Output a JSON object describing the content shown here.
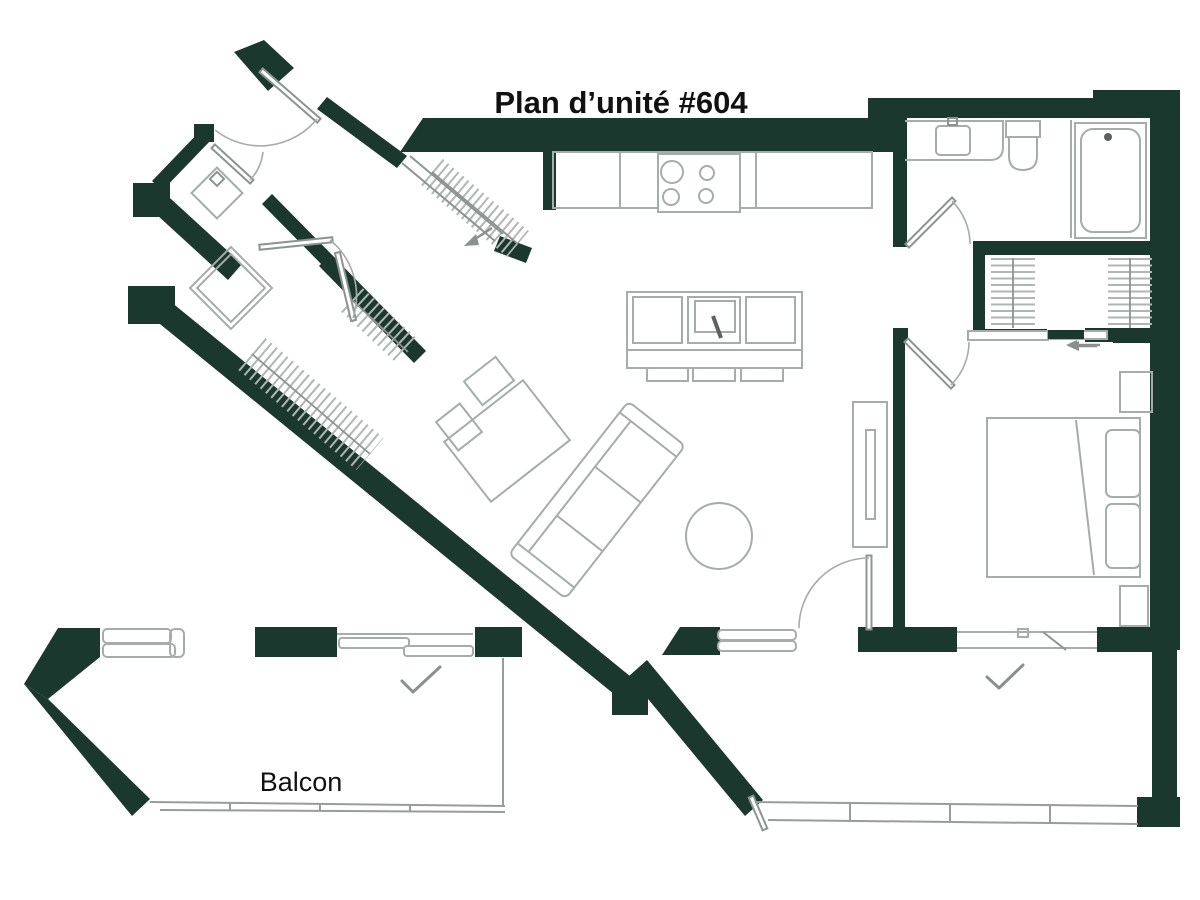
{
  "title": "Plan d’unité #604",
  "labels": {
    "balcony": "Balcon"
  },
  "colors": {
    "wall": "#1b382f",
    "fline": "#a6acaa",
    "fline_dark": "#8d9490",
    "railing": "#979d9a",
    "hatch": "#b0b6b3",
    "annotation": "#8a908d",
    "text": "#111111"
  }
}
